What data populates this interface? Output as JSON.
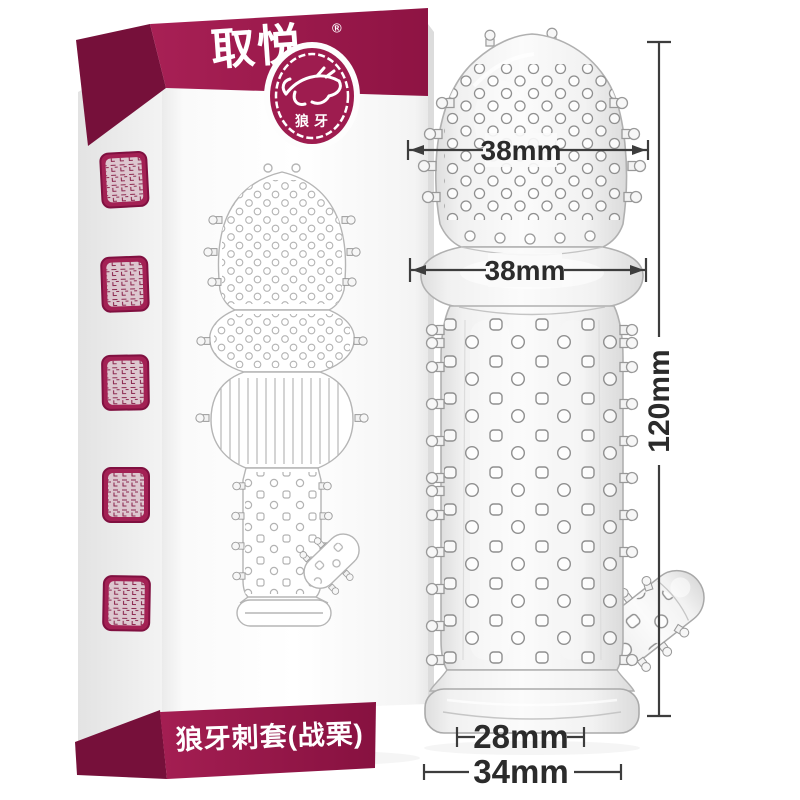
{
  "page": {
    "background": "#ffffff",
    "kind": "e-commerce product photo with size diagram"
  },
  "colors": {
    "maroon": "#9E1C4F",
    "maroon_dark": "#76103A",
    "dimension_line": "#3D3D3D",
    "dimension_text": "#2B2B2B"
  },
  "box": {
    "brand_logo": "取悦",
    "reg_mark": "®",
    "badge": {
      "icon": "wolf-stamp",
      "label": "狼牙"
    },
    "title": "狼牙刺套(战栗)",
    "side_seal_stamps": {
      "count": 5
    }
  },
  "product": {
    "description_icon": "transparent-spiked-sleeve",
    "dimensions": {
      "head_width": "38mm",
      "bulb_width": "38mm",
      "total_length": "120mm",
      "opening_width": "28mm",
      "base_width": "34mm"
    }
  }
}
